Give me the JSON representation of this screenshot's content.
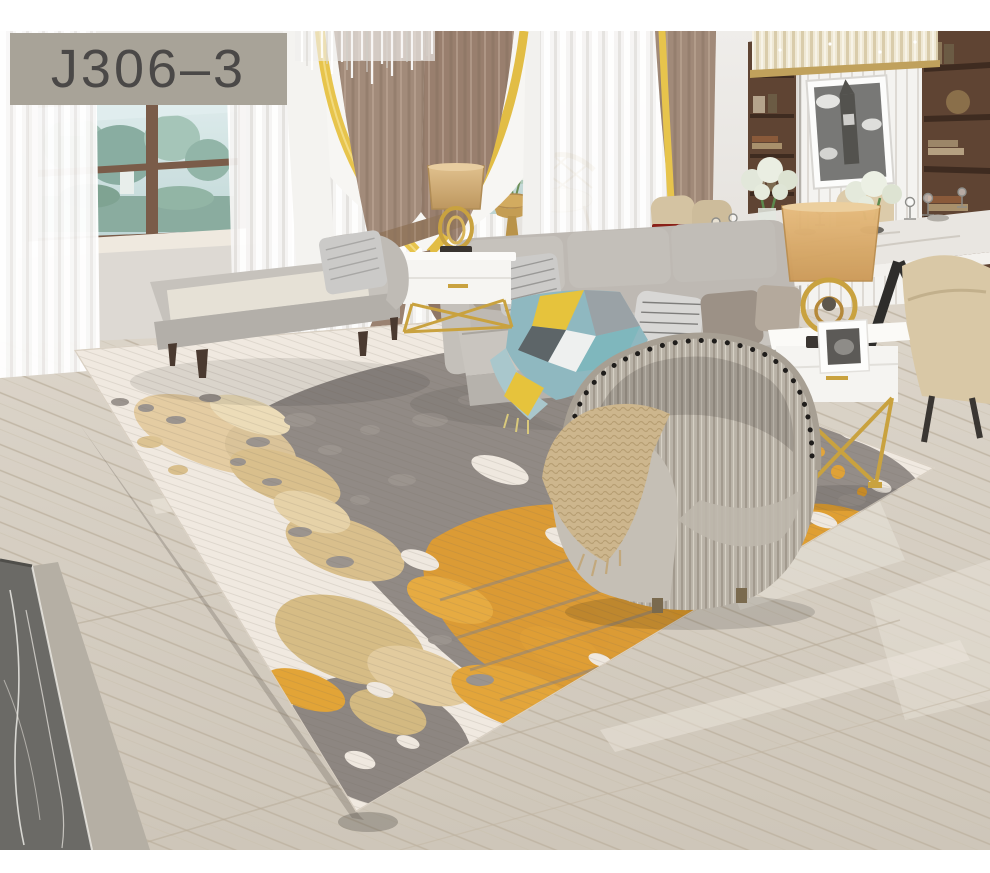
{
  "product_label": {
    "text": "J306–3"
  },
  "scene_description": "Staged living-room product photo of an abstract area rug (ivory field with gray, tan and orange splotches) laid diagonally on a light diagonal-plank wood floor; gray fabric sofa with striped pillows and teal-yellow throw, gray chaise lounge, pleated barrel accent chair with knit throw, white gold-leg side tables with brass lamps, taupe curtains with gold trim, garden windows with sheers, hanging lantern, rattan chair, and a dining area with marble table, cream chairs, hydrangeas, wooden bookshelves, Big Ben artwork and a linear crystal chandelier.",
  "objects": [
    "product-label",
    "window-left",
    "garden-view",
    "sheer-curtains",
    "curtain-taupe-pair",
    "curtain-gold-trim",
    "crystal-pelmet",
    "pendant-lantern",
    "rattan-chair",
    "gold-pedestal-table",
    "flower-vase",
    "chaise-lounge",
    "sofa",
    "throw-blanket",
    "pillows",
    "nightstand-left",
    "table-lamp-left",
    "console-table",
    "carriage-model",
    "dining-table",
    "dining-chairs",
    "wine-glasses",
    "hydrangea-bouquets",
    "bookshelf-left",
    "bookshelf-right",
    "big-ben-art",
    "linear-chandelier",
    "accent-barrel-chair",
    "knit-throw",
    "nightstand-right",
    "table-lamp-right",
    "photo-frame",
    "area-rug",
    "wood-floor",
    "dark-marble-step"
  ],
  "colors": {
    "label_bg": "#a8a398",
    "label_text": "#4a4847",
    "wall": "#e9e6e2",
    "floor_wood": "#d5cec3",
    "marble_dark": "#6b6a66",
    "curtain_taupe": "#a18a79",
    "curtain_gold_trim": "#e7c44c",
    "sofa_gray": "#c2beb8",
    "rug_ivory": "#f0e9e0",
    "rug_gray": "#918a85",
    "rug_tan": "#dcc392",
    "rug_orange": "#e09b2f",
    "shelf_wood": "#5f4433",
    "gold_accent": "#c9a23f",
    "throw_teal": "#7fb7bd",
    "throw_yellow": "#e6c33c"
  }
}
